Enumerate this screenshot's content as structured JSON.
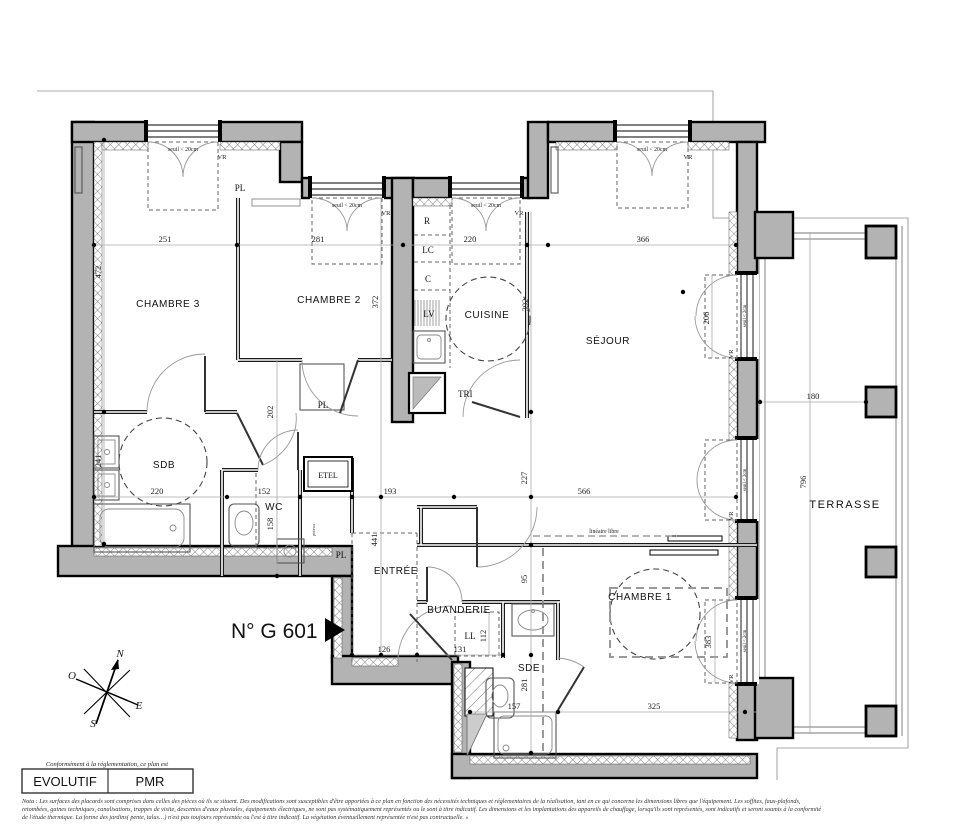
{
  "plan": {
    "unit_label": "N° G 601",
    "rooms": {
      "chambre3": "CHAMBRE 3",
      "chambre2": "CHAMBRE 2",
      "cuisine": "CUISINE",
      "sejour": "SÉJOUR",
      "sdb": "SDB",
      "wc": "WC",
      "entree": "ENTRÉE",
      "buanderie": "BUANDERIE",
      "sde": "SDE",
      "chambre1": "CHAMBRE 1",
      "terrasse": "TERRASSE"
    },
    "fixtures": {
      "pl": "PL",
      "r": "R",
      "lc": "LC",
      "c": "C",
      "lv": "LV",
      "tri": "TRI",
      "etel": "ETEL",
      "ll": "LL",
      "poteau": "poteau"
    },
    "annotations": {
      "seuil20": "seuil < 20cm",
      "seuil2": "seuil < 2cm",
      "vr": "VR",
      "lineaire": "linéaire libre"
    },
    "dims": {
      "d251": "251",
      "d472": "472",
      "d281": "281",
      "d372": "372",
      "d220a": "220",
      "d392": "392",
      "d366": "366",
      "d206": "206",
      "d241": "241",
      "d220b": "220",
      "d202": "202",
      "d152": "152",
      "d158": "158",
      "d193": "193",
      "d227": "227",
      "d566": "566",
      "d441": "441",
      "d126": "126",
      "d131": "131",
      "d112": "112",
      "d95": "95",
      "d281b": "281",
      "d157": "157",
      "d325": "325",
      "d383": "383",
      "d180": "180",
      "d796": "796"
    }
  },
  "compass": {
    "n": "N",
    "o": "O",
    "e": "E",
    "s": "S"
  },
  "footer": {
    "conformity": "Conformément à la réglementation, ce plan est",
    "evolutif": "EVOLUTIF",
    "pmr": "PMR",
    "nota1": "Nota : Les surfaces des placards sont comprises dans celles des pièces où ils se situent. Des modifications sont susceptibles d'être apportées à ce plan en fonction des nécessités techniques et réglementaires de la réalisation, tant en ce qui concerne les dimensions libres que l'équipement.  Les soffites, faux-plafonds,",
    "nota2": "retombées, gaines techniques, canalisations, trappes de visite, descentes d'eaux pluviales, équipements électriques, ne sont pas systématiquement représentés ou le sont à titre indicatif. Les dimensions et les implantations des appareils de chauffage, lorsqu'ils sont représentés, sont indicatifs et seront soumis à la conformité",
    "nota3": "de l'étude thermique. La forme des jardins( pente, talus…) n'est pas toujours représentée ou l'est à titre indicatif. La végétation éventuellement représentée n'est pas contractuelle. »"
  }
}
